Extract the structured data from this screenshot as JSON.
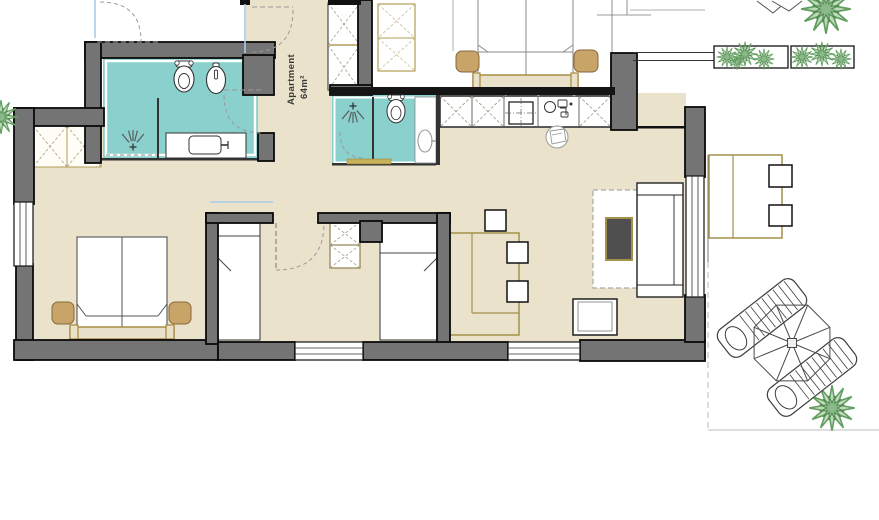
{
  "apartment_label": {
    "line1": "Apartment",
    "line2": "64m²"
  },
  "colors": {
    "background": "#ffffff",
    "wall_fill": "#747474",
    "wall_outline": "#0a0a0a",
    "floor": "#eae2ca",
    "bathroom_floor": "#8ad0cd",
    "furniture_wood_outline": "#a3914a",
    "wood_fill": "#c9a469",
    "threshold_tan": "#c9b25c",
    "plant_green": "#5f9e5f",
    "glass_line_blue": "#a6cdea",
    "door_arc_gray": "#9a9a9a",
    "coffee_table_fill": "#4f4f4f"
  },
  "fixtures": {
    "bathroom1": [
      "toilet",
      "bidet",
      "shower",
      "vanity-sink"
    ],
    "bathroom2": [
      "shower",
      "toilet",
      "sink"
    ],
    "kitchen": [
      "cabinets",
      "cooktop",
      "sink"
    ],
    "bedrooms": [
      "double-bed",
      "single-bed",
      "single-bed",
      "wardrobes",
      "nightstands"
    ],
    "living": [
      "sofa-bed",
      "coffee-table",
      "side-table",
      "dining-table",
      "chairs"
    ],
    "outdoor": [
      "planter-boxes",
      "parasol",
      "sun-loungers",
      "terrace-table",
      "plants"
    ]
  }
}
